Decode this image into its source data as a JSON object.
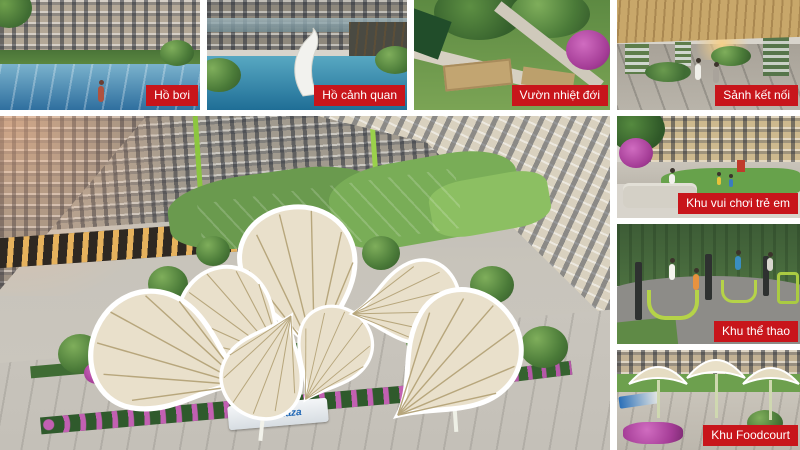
{
  "style": {
    "canvas_bg": "#FFFFFF",
    "label_bg": "#C8151B",
    "label_text_color": "#FFFFFF"
  },
  "tiles": {
    "pool": {
      "label": "Hồ bơi",
      "description": "Residents swimming in a blue pool framed by palm leaves, greenery and grey high-rise apartment towers"
    },
    "lake": {
      "label": "Hồ cảnh quan",
      "description": "Landscape lake with a white whale sculpture in front of a glass podium and dark timber pergola"
    },
    "garden": {
      "label": "Vườn nhiệt đới",
      "description": "Terraced tropical garden with dense trees, tan planter walls, light walkways and magenta bougainvillea"
    },
    "lobby": {
      "label": "Sảnh kết nối",
      "description": "Connecting lobby under a wide timber-slat canopy with plant-wrapped columns and two residents walking"
    },
    "main": {
      "sign_text": "FPT Plaza",
      "description": "Aerial view of the central courtyard: leaf-shaped fabric canopies over a plaza, lawns, trees, retail podium, walkway with purple flower beds"
    },
    "playground": {
      "label": "Khu vui chơi trẻ em",
      "description": "Children playing on a courtyard lawn below cream towers, lounge sofas and bougainvillea in the foreground"
    },
    "sports": {
      "label": "Khu thể thao",
      "description": "Outdoor gym with lime-green exercise machines on dark rubber paving, residents working out under trees"
    },
    "foodcourt": {
      "label": "Khu Foodcourt",
      "description": "Food court plaza shaded by cream umbrella canopies with lawns, planting and pink flowers"
    }
  }
}
